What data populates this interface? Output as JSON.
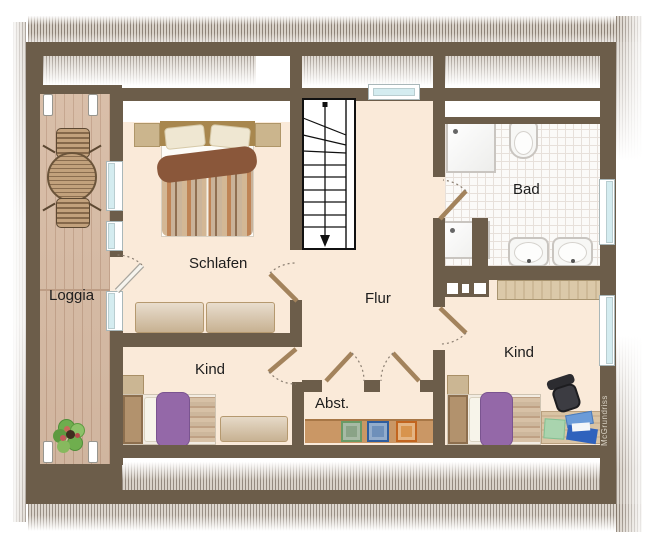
{
  "watermark": "McGrundriss",
  "rooms": [
    {
      "id": "loggia",
      "label": "Loggia"
    },
    {
      "id": "schlafen",
      "label": "Schlafen"
    },
    {
      "id": "flur",
      "label": "Flur"
    },
    {
      "id": "bad",
      "label": "Bad"
    },
    {
      "id": "kind_left",
      "label": "Kind"
    },
    {
      "id": "kind_right",
      "label": "Kind"
    },
    {
      "id": "abstellraum",
      "label": "Abst."
    }
  ],
  "palette": {
    "wall": "#6c5d4a",
    "floor": "#faead9",
    "deck": "#d7bba4",
    "tile": "#fbfaf8",
    "window_glass": "#d4ecf0",
    "door_leaf": "#a3835c",
    "purple_bed": "#9468a8",
    "shelf": "#ca9765",
    "appliance_green": "#8aa387",
    "appliance_blue": "#6e90ba",
    "appliance_orange": "#d8944d"
  }
}
